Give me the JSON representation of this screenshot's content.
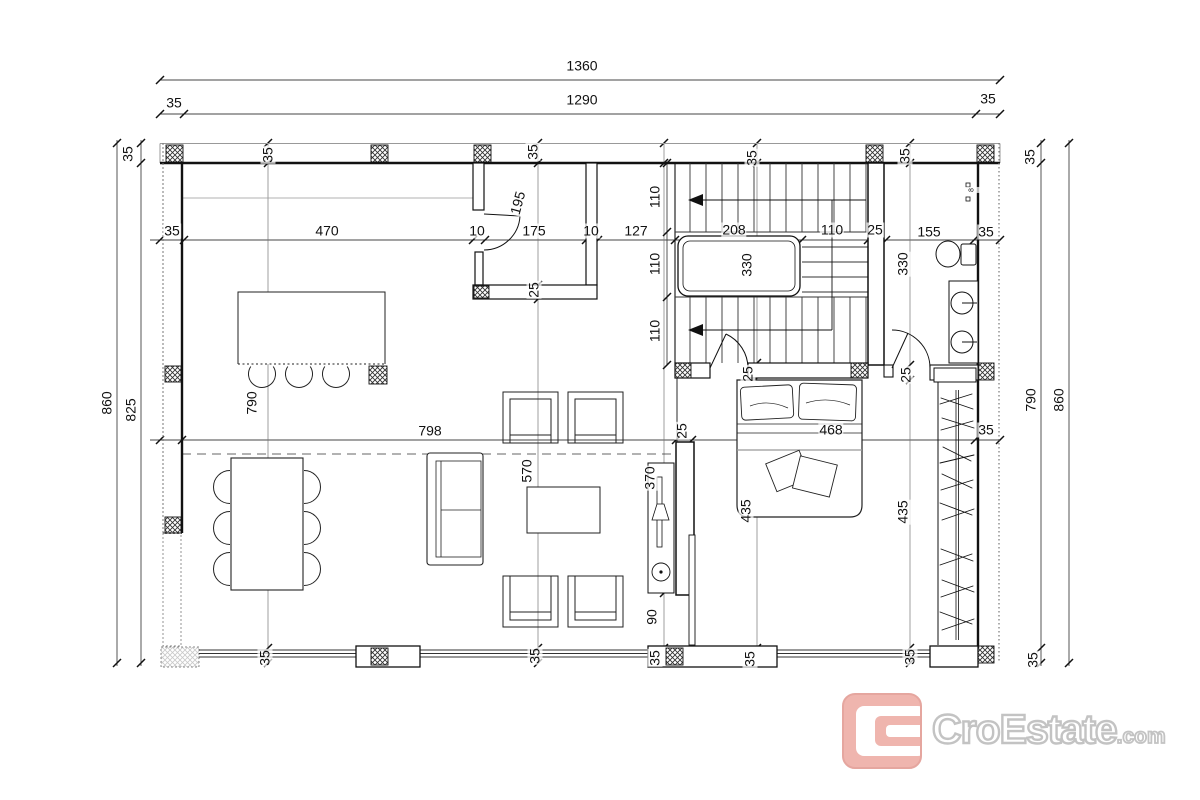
{
  "document": {
    "type": "architectural-floor-plan",
    "units": "cm",
    "style": "black line work on white, crosshatched columns, dimension chains"
  },
  "overall_dimensions": {
    "total_width": "1360",
    "inner_width": "1290",
    "left_total_height": "860",
    "left_inner_height": "825",
    "right_inner_height": "790",
    "right_total_height": "860",
    "typical_wall": "35"
  },
  "dimension_chains": {
    "top_total": [
      "1360"
    ],
    "top_inner": [
      "35",
      "1290",
      "35"
    ],
    "upper_horizontal": [
      "35",
      "470",
      "10",
      "175",
      "10",
      "127",
      "208",
      "110",
      "25",
      "155",
      "35"
    ],
    "middle_horizontal": [
      "35",
      "798",
      "25",
      "468",
      "35"
    ],
    "stair_vertical": [
      "110",
      "110",
      "110"
    ],
    "left_vertical": [
      "35",
      "825",
      "860"
    ],
    "right_vertical": [
      "35",
      "790",
      "35",
      "860"
    ],
    "room_depths": [
      "195",
      "330",
      "330",
      "790",
      "570",
      "370",
      "435",
      "435",
      "468",
      "90",
      "25",
      "25",
      "25"
    ]
  },
  "furniture": [
    "kitchen-island",
    "bar-stools",
    "dining-table",
    "dining-chairs",
    "sofa",
    "coffee-table",
    "armchairs",
    "tv-console",
    "double-bed",
    "wardrobe",
    "u-shaped-stair",
    "toilet",
    "double-washbasin"
  ],
  "logo": {
    "brand": "CroEstate",
    "tld": ".com",
    "accent_color": "#eca69d",
    "outline_color": "#b7b7b7"
  },
  "dimension_labels": [
    {
      "t": "1360",
      "x": 582,
      "y": 66,
      "r": 0
    },
    {
      "t": "1290",
      "x": 582,
      "y": 100,
      "r": 0
    },
    {
      "t": "35",
      "x": 174,
      "y": 103,
      "r": 0
    },
    {
      "t": "35",
      "x": 988,
      "y": 99,
      "r": 0
    },
    {
      "t": "35",
      "x": 128,
      "y": 154,
      "r": -90
    },
    {
      "t": "860",
      "x": 107,
      "y": 403,
      "r": -90
    },
    {
      "t": "825",
      "x": 131,
      "y": 410,
      "r": -90
    },
    {
      "t": "35",
      "x": 1030,
      "y": 157,
      "r": -90
    },
    {
      "t": "790",
      "x": 1031,
      "y": 400,
      "r": -90
    },
    {
      "t": "860",
      "x": 1059,
      "y": 400,
      "r": -90
    },
    {
      "t": "35",
      "x": 1033,
      "y": 660,
      "r": -90
    },
    {
      "t": "35",
      "x": 172,
      "y": 231,
      "r": 0
    },
    {
      "t": "470",
      "x": 327,
      "y": 231,
      "r": 0
    },
    {
      "t": "10",
      "x": 477,
      "y": 231,
      "r": 0
    },
    {
      "t": "175",
      "x": 534,
      "y": 231,
      "r": 0
    },
    {
      "t": "10",
      "x": 591,
      "y": 231,
      "r": 0
    },
    {
      "t": "127",
      "x": 636,
      "y": 231,
      "r": 0
    },
    {
      "t": "208",
      "x": 734,
      "y": 230,
      "r": 0
    },
    {
      "t": "110",
      "x": 832,
      "y": 230,
      "r": 0
    },
    {
      "t": "25",
      "x": 875,
      "y": 230,
      "r": 0
    },
    {
      "t": "155",
      "x": 929,
      "y": 232,
      "r": 0
    },
    {
      "t": "35",
      "x": 986,
      "y": 232,
      "r": 0
    },
    {
      "t": "35",
      "x": 268,
      "y": 155,
      "r": -90
    },
    {
      "t": "35",
      "x": 533,
      "y": 152,
      "r": -90
    },
    {
      "t": "35",
      "x": 752,
      "y": 158,
      "r": -90
    },
    {
      "t": "35",
      "x": 905,
      "y": 156,
      "r": -90
    },
    {
      "t": "110",
      "x": 655,
      "y": 197,
      "r": -90
    },
    {
      "t": "110",
      "x": 655,
      "y": 264,
      "r": -90
    },
    {
      "t": "110",
      "x": 655,
      "y": 331,
      "r": -90
    },
    {
      "t": "330",
      "x": 747,
      "y": 265,
      "r": -90
    },
    {
      "t": "330",
      "x": 903,
      "y": 264,
      "r": -90
    },
    {
      "t": "195",
      "x": 518,
      "y": 203,
      "r": -75
    },
    {
      "t": "25",
      "x": 534,
      "y": 290,
      "r": -90
    },
    {
      "t": "790",
      "x": 252,
      "y": 403,
      "r": -90
    },
    {
      "t": "798",
      "x": 430,
      "y": 431,
      "r": 0
    },
    {
      "t": "25",
      "x": 682,
      "y": 431,
      "r": -90
    },
    {
      "t": "468",
      "x": 831,
      "y": 430,
      "r": 0
    },
    {
      "t": "35",
      "x": 986,
      "y": 430,
      "r": 0
    },
    {
      "t": "570",
      "x": 527,
      "y": 471,
      "r": -90
    },
    {
      "t": "370",
      "x": 650,
      "y": 478,
      "r": -90
    },
    {
      "t": "25",
      "x": 748,
      "y": 374,
      "r": -90
    },
    {
      "t": "25",
      "x": 906,
      "y": 375,
      "r": -90
    },
    {
      "t": "435",
      "x": 746,
      "y": 511,
      "r": -90
    },
    {
      "t": "435",
      "x": 903,
      "y": 512,
      "r": -90
    },
    {
      "t": "90",
      "x": 652,
      "y": 617,
      "r": -90
    },
    {
      "t": "35",
      "x": 265,
      "y": 658,
      "r": -90
    },
    {
      "t": "35",
      "x": 535,
      "y": 656,
      "r": -90
    },
    {
      "t": "35",
      "x": 655,
      "y": 658,
      "r": -90
    },
    {
      "t": "35",
      "x": 750,
      "y": 659,
      "r": -90
    },
    {
      "t": "35",
      "x": 910,
      "y": 657,
      "r": -90
    },
    {
      "t": "8",
      "x": 972,
      "y": 190,
      "r": -90,
      "fs": 7
    }
  ]
}
